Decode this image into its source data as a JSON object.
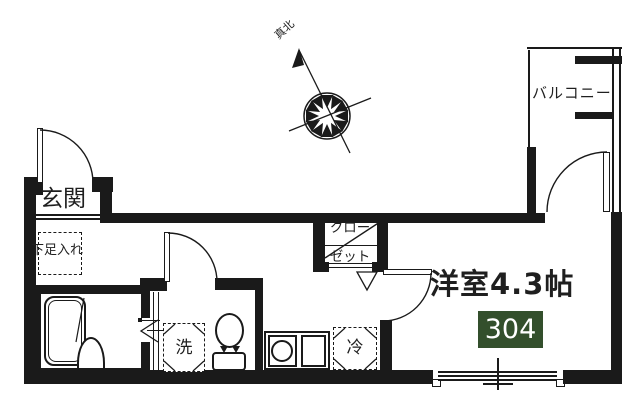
{
  "plan_type": "floor-plan",
  "colors": {
    "background": "#ffffff",
    "line": "#1a1a1a",
    "unit_badge_background": "#334f2c",
    "unit_badge_text": "#ffffff"
  },
  "compass": {
    "label": "真北"
  },
  "balcony": {
    "label": "バルコニー"
  },
  "entrance": {
    "label": "玄関"
  },
  "storage": {
    "shoe_cabinet_label": "下足入れ",
    "closet_label_line1": "クロー",
    "closet_label_line2": "ゼット"
  },
  "utilities": {
    "washer_label": "洗",
    "fridge_label": "冷"
  },
  "main_room": {
    "label": "洋室4.3帖",
    "unit_badge": "304"
  },
  "icons": {
    "compass": "compass-rose-icon",
    "toilet": "toilet-icon",
    "bathtub": "bathtub-icon",
    "kitchen_sink": "sink-burner-icon",
    "doors": "door-swing-icon"
  }
}
